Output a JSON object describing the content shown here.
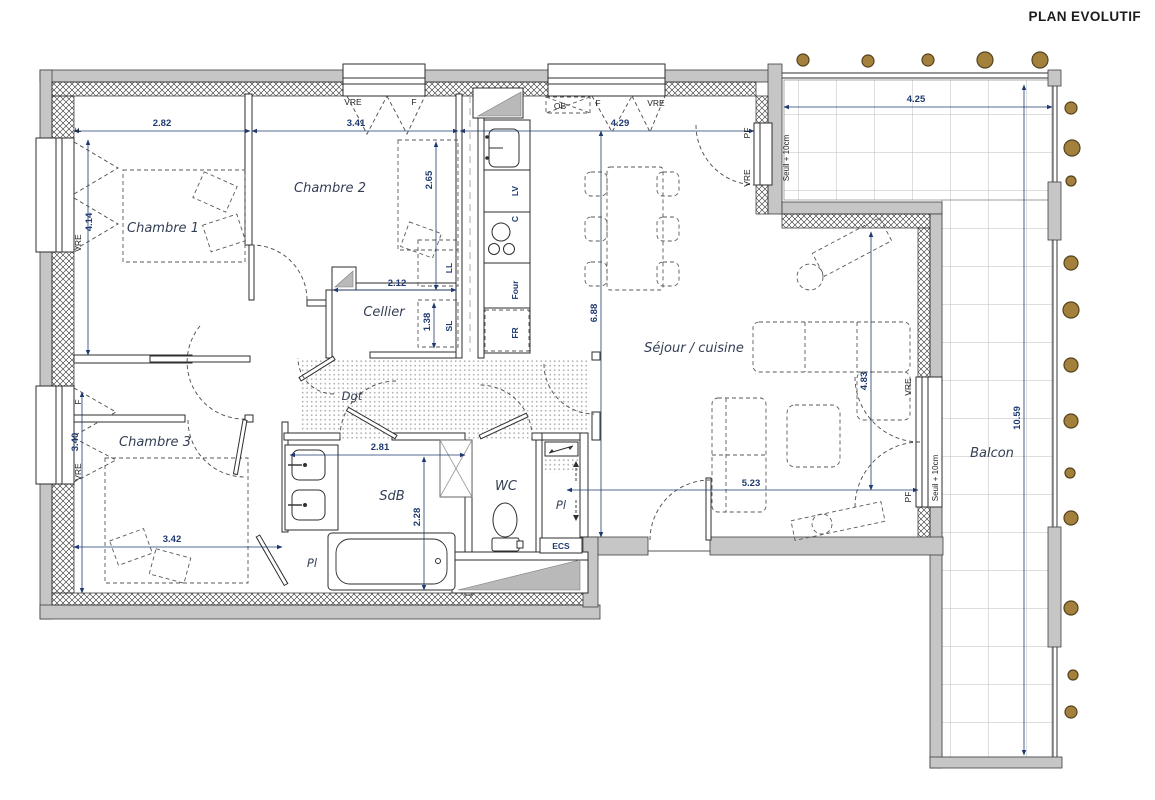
{
  "title": "PLAN EVOLUTIF",
  "rooms": {
    "chambre1": "Chambre 1",
    "chambre2": "Chambre 2",
    "chambre3": "Chambre 3",
    "cellier": "Cellier",
    "dgt": "Dgt",
    "sdb": "SdB",
    "wc": "WC",
    "sejour": "Séjour / cuisine",
    "balcon": "Balcon",
    "placard": "Pl"
  },
  "appliances": {
    "lv": "LV",
    "c": "C",
    "four": "Four",
    "fr": "FR",
    "sl": "SL",
    "ll": "LL",
    "ecs": "ECS"
  },
  "openings": {
    "vre": "VRE",
    "f": "F",
    "ob": "OB",
    "pf": "PF"
  },
  "annotations": {
    "seuil": "Seuil + 10cm"
  },
  "dimensions": {
    "d282": "2.82",
    "d341": "3.41",
    "d429": "4.29",
    "d425": "4.25",
    "d414": "4.14",
    "d265": "2.65",
    "d212": "2.12",
    "d138": "1.38",
    "d688": "6.88",
    "d483": "4.83",
    "d523": "5.23",
    "d340": "3.40",
    "d342": "3.42",
    "d281": "2.81",
    "d228": "2.28",
    "d1059": "10.59"
  },
  "colors": {
    "wall_gray": "#c6c6c6",
    "dim_text": "#1e3a70",
    "room_text": "#333f54",
    "dot_fill": "#a3803c",
    "dot_stroke": "#54431c"
  }
}
